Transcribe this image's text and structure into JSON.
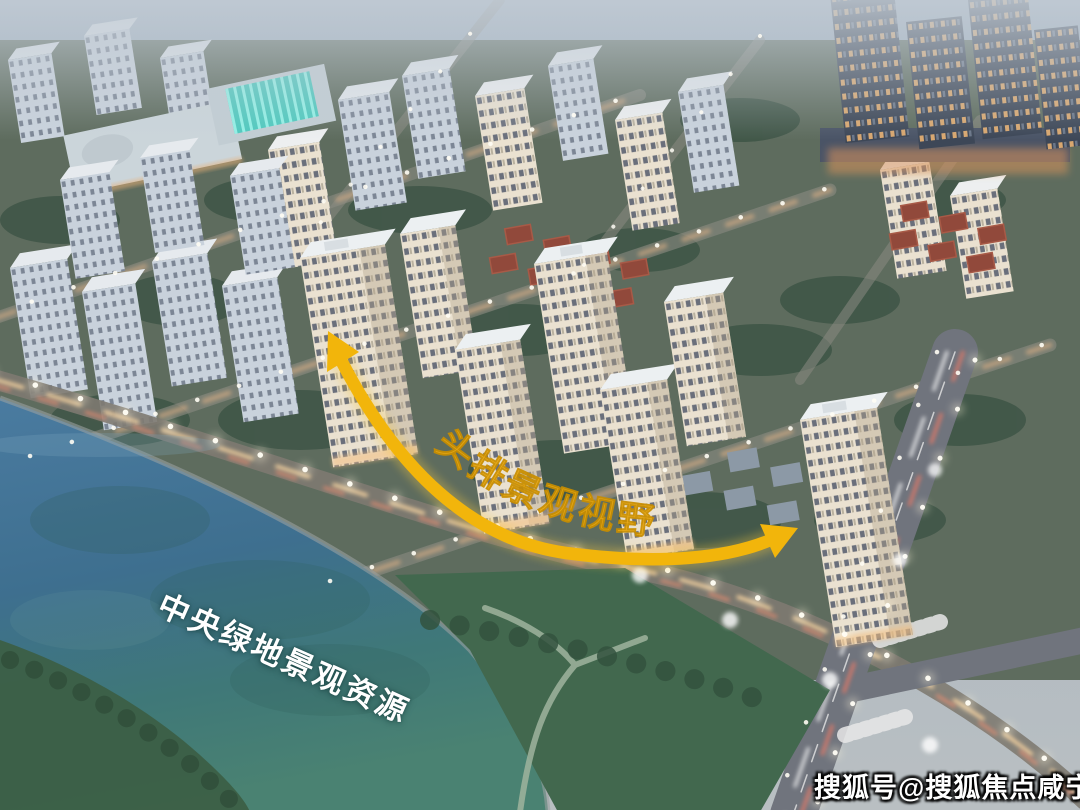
{
  "annotations": {
    "view_corridor_label": "头排景观视野",
    "green_space_label": "中央绿地景观资源",
    "watermark": "搜狐号@搜狐焦点咸宁站"
  },
  "colors": {
    "arrow_gold": "#F2B50B",
    "arrow_glow": "#F7C93E",
    "view_label_gold": "#ECA90D",
    "view_label_edge": "#C98E00",
    "green_label_white": "#FFFFFF",
    "watermark_white": "#FFFFFF",
    "water_blue": "#4A7BA0",
    "water_teal": "#3F7878",
    "park_green": "#42684E",
    "bank_green": "#3C5F46",
    "city_ground": "#5E6C5E",
    "facade_cream": "#EAE1D0",
    "tower_blue_grey": "#C9D2DC",
    "office_dark": "#3D4757",
    "street_glow": "#E8B077",
    "villa_roof_red": "#91493B",
    "school_roof_cyan": "#49C9BD"
  }
}
